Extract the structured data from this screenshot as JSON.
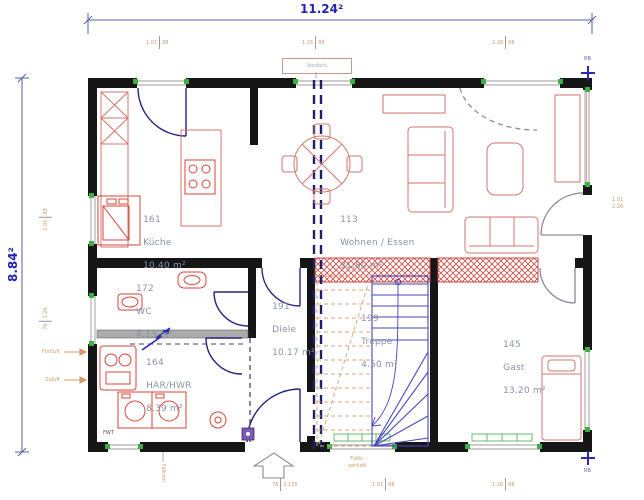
{
  "dims": {
    "width": "11.24²",
    "height": "8.84²"
  },
  "rooms": {
    "kueche": {
      "number": "161",
      "name": "Küche",
      "area": "10.40 m²"
    },
    "wohnen": {
      "number": "113",
      "name": "Wohnen / Essen",
      "area": "31.80 m²"
    },
    "wc": {
      "number": "172",
      "name": "WC",
      "area": "4.13 m²"
    },
    "hwr": {
      "number": "164",
      "name": "HAR/HWR",
      "area": "8.39 m²"
    },
    "diele": {
      "number": "191",
      "name": "Diele",
      "area": "10.17 m²"
    },
    "treppe": {
      "number": "199",
      "name": "Treppe",
      "area": "4.50 m²"
    },
    "gast": {
      "number": "145",
      "name": "Gast",
      "area": "13.20 m²"
    }
  },
  "annotations": {
    "vent_top": "Fortluft",
    "vent_bottom": "Zuluft",
    "ref_top": "RB",
    "ref_bottom": "RB",
    "top_stamp": "Vordach",
    "downpipe": "Fallrohr",
    "entry_note_line1": "Fußb.",
    "entry_note_line2": "vertieft",
    "fwt": "FWT"
  },
  "window_marks": [
    {
      "a": "1.01",
      "b": "88"
    },
    {
      "a": "1.26",
      "b": "88"
    },
    {
      "a": "2.26",
      "b": "88"
    },
    {
      "a": "1.01",
      "b": "88"
    },
    {
      "a": "76",
      "b": "1.26"
    },
    {
      "a": "1.01",
      "b": "2.26"
    },
    {
      "a": "76",
      "b": "2.135"
    },
    {
      "a": "1.01",
      "b": "88"
    },
    {
      "a": "1.26",
      "b": "88"
    }
  ],
  "colors": {
    "wall": "#161616",
    "furniture": "#d3766c",
    "appliance": "#d8453a",
    "door": "#23237d",
    "stairs_blue": "#4646bb",
    "stairs_upper": "#d9a977",
    "window_jamb_green": "#3fae45",
    "hatch_red": "#cc4840",
    "dim_blue": "#2424b4",
    "mark_orange": "#d09a6c",
    "label_gray": "#8a93a4"
  }
}
